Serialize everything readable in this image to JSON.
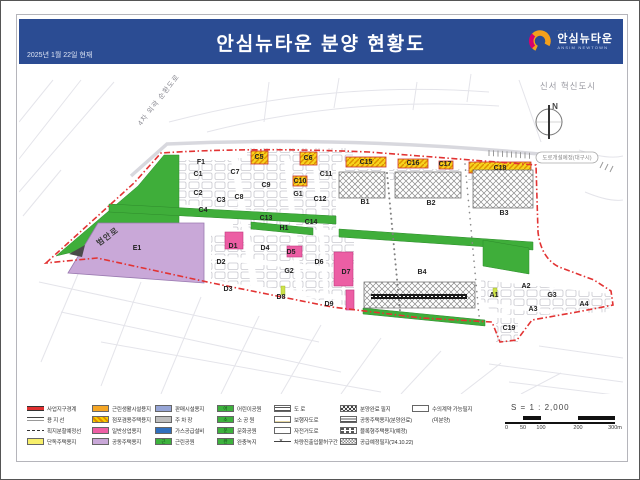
{
  "header": {
    "title": "안심뉴타운 분양 현황도",
    "date": "2025년 1월 22일 현재",
    "logo": {
      "name": "안심뉴타운",
      "sub": "ANSIM NEWTOWN"
    },
    "accent_color": "#2b4c93"
  },
  "map": {
    "annotations": {
      "district": "신서 혁신도시",
      "ring_road": "4차 외곽 순환도로",
      "west_road": "범안로",
      "planned_road": "도로개설예정(대구시)",
      "compass": "N"
    },
    "colors": {
      "boundary": "#e23333",
      "green": "#3fae3a",
      "apartment": "#c9a8d8",
      "commercial_sold": "#ec5ea4",
      "shop_lot": "#f6d41e"
    },
    "lots": [
      {
        "id": "F1",
        "x": 182,
        "y": 100
      },
      {
        "id": "C1",
        "x": 179,
        "y": 112
      },
      {
        "id": "C2",
        "x": 179,
        "y": 131
      },
      {
        "id": "C3",
        "x": 202,
        "y": 138
      },
      {
        "id": "C4",
        "x": 184,
        "y": 148
      },
      {
        "id": "C5",
        "x": 240,
        "y": 95
      },
      {
        "id": "C6",
        "x": 289,
        "y": 96
      },
      {
        "id": "C7",
        "x": 216,
        "y": 110
      },
      {
        "id": "C8",
        "x": 220,
        "y": 135
      },
      {
        "id": "C9",
        "x": 247,
        "y": 123
      },
      {
        "id": "C10",
        "x": 281,
        "y": 119
      },
      {
        "id": "C11",
        "x": 307,
        "y": 112
      },
      {
        "id": "C12",
        "x": 301,
        "y": 137
      },
      {
        "id": "C13",
        "x": 247,
        "y": 156
      },
      {
        "id": "C14",
        "x": 292,
        "y": 160
      },
      {
        "id": "C15",
        "x": 347,
        "y": 100
      },
      {
        "id": "C16",
        "x": 394,
        "y": 101
      },
      {
        "id": "C17",
        "x": 426,
        "y": 102
      },
      {
        "id": "C18",
        "x": 481,
        "y": 106
      },
      {
        "id": "C19",
        "x": 490,
        "y": 266
      },
      {
        "id": "B1",
        "x": 346,
        "y": 140
      },
      {
        "id": "B2",
        "x": 412,
        "y": 141
      },
      {
        "id": "B3",
        "x": 485,
        "y": 151
      },
      {
        "id": "B4",
        "x": 403,
        "y": 210
      },
      {
        "id": "G1",
        "x": 279,
        "y": 132
      },
      {
        "id": "G2",
        "x": 270,
        "y": 209
      },
      {
        "id": "G3",
        "x": 533,
        "y": 233
      },
      {
        "id": "H1",
        "x": 265,
        "y": 166
      },
      {
        "id": "E1",
        "x": 118,
        "y": 186
      },
      {
        "id": "D1",
        "x": 214,
        "y": 184
      },
      {
        "id": "D2",
        "x": 202,
        "y": 200
      },
      {
        "id": "D3",
        "x": 209,
        "y": 227
      },
      {
        "id": "D4",
        "x": 246,
        "y": 186
      },
      {
        "id": "D5",
        "x": 272,
        "y": 190
      },
      {
        "id": "D6",
        "x": 300,
        "y": 200
      },
      {
        "id": "D7",
        "x": 327,
        "y": 210
      },
      {
        "id": "D8",
        "x": 262,
        "y": 235
      },
      {
        "id": "D9",
        "x": 310,
        "y": 242
      },
      {
        "id": "A1",
        "x": 475,
        "y": 233
      },
      {
        "id": "A2",
        "x": 507,
        "y": 224
      },
      {
        "id": "A3",
        "x": 514,
        "y": 247
      },
      {
        "id": "A4",
        "x": 565,
        "y": 242
      }
    ]
  },
  "legend": {
    "columns": [
      {
        "items": [
          {
            "type": "line-red",
            "label": "사업지구경계"
          },
          {
            "type": "line-double",
            "label": "용 지 선"
          },
          {
            "type": "line-dashed",
            "label": "획지분할예정선"
          },
          {
            "type": "fill-yellow",
            "label": "단독주택용지"
          }
        ]
      },
      {
        "items": [
          {
            "type": "fill-orange",
            "label": "근린생활시설용지"
          },
          {
            "type": "hatch-orange",
            "label": "점포겸용주택용지"
          },
          {
            "type": "fill-pink",
            "label": "일반상업용지"
          },
          {
            "type": "fill-purple",
            "label": "공동주택용지"
          }
        ]
      },
      {
        "items": [
          {
            "type": "fill-blue-light",
            "label": "판매시설용지"
          },
          {
            "type": "fill-gray",
            "label": "주 차 장"
          },
          {
            "type": "fill-blue",
            "label": "가스공급설비"
          },
          {
            "type": "fill-green",
            "glyph": "근",
            "label": "근린공원"
          }
        ]
      },
      {
        "items": [
          {
            "type": "fill-green",
            "glyph": "어",
            "label": "어린이공원"
          },
          {
            "type": "fill-green",
            "glyph": "소",
            "label": "소 공 원"
          },
          {
            "type": "fill-green",
            "glyph": "문",
            "label": "문화공원"
          },
          {
            "type": "fill-green",
            "glyph": "완",
            "label": "완충녹지"
          }
        ]
      },
      {
        "items": [
          {
            "type": "icon-road",
            "label": "도  로"
          },
          {
            "type": "icon-ped",
            "label": "보행자도로"
          },
          {
            "type": "icon-bike",
            "label": "자전거도로"
          },
          {
            "type": "icon-noaccess",
            "glyph": "✕",
            "label": "차량진출입불허구간"
          }
        ]
      },
      {
        "items": [
          {
            "type": "pat-checker-dark",
            "label": "분양완료 필지"
          },
          {
            "type": "pat-hlines",
            "label": "공동주택용지(분양완료)"
          },
          {
            "type": "pat-brick",
            "label": "블록형주택용지(예정)"
          },
          {
            "type": "pat-checker",
            "label": "공급예정필지('24.10.22)"
          }
        ]
      },
      {
        "items": [
          {
            "type": "pat-crosshatch",
            "label": "수의계약 가능필지"
          },
          {
            "type": "sw-none",
            "label": "(미분양)"
          }
        ]
      }
    ]
  },
  "scale": {
    "title": "S = 1 : 2,000",
    "ticks": [
      "0",
      "50",
      "100",
      "200",
      "300m"
    ]
  }
}
